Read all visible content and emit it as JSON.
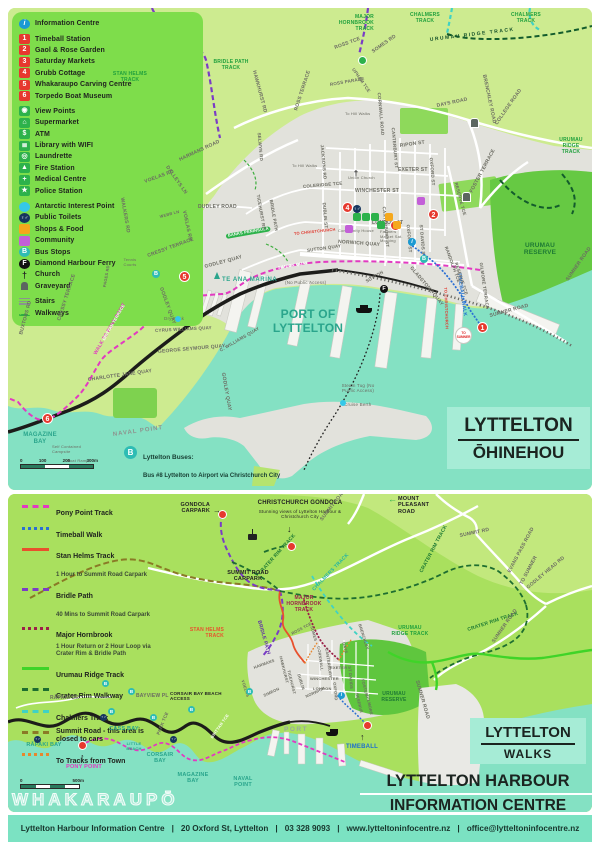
{
  "palette": {
    "land_top": "#cdeb90",
    "land_bottom": "#a9e05e",
    "water": "#84e1c3",
    "urban": "#e2e2dc",
    "legend_green": "#7edd4b",
    "title_box": "#a6ecd6",
    "footer": "#7be2c2",
    "marker_red": "#e6392e",
    "bus_teal": "#2ebcb4",
    "info_blue": "#1b9ad2",
    "shops_orange": "#f5a81c",
    "community_purple": "#c35fd8",
    "antarctic_cyan": "#35c8e8"
  },
  "legend": {
    "info_label": "Information Centre",
    "info_letter": "i",
    "bus_letter": "B",
    "ferry_letter": "F",
    "numbered": [
      {
        "num": "1",
        "label": "Timeball Station"
      },
      {
        "num": "2",
        "label": "Gaol & Rose Garden"
      },
      {
        "num": "3",
        "label": "Saturday Markets"
      },
      {
        "num": "4",
        "label": "Grubb Cottage"
      },
      {
        "num": "5",
        "label": "Whakaraupo Carving Centre"
      },
      {
        "num": "6",
        "label": "Torpedo Boat Museum"
      }
    ],
    "amenities": [
      {
        "glyph": "◉",
        "label": "View Points"
      },
      {
        "glyph": "⌂",
        "label": "Supermarket"
      },
      {
        "glyph": "$",
        "label": "ATM"
      },
      {
        "glyph": "≣",
        "label": "Library with WIFI"
      },
      {
        "glyph": "◎",
        "label": "Laundrette"
      },
      {
        "glyph": "▲",
        "label": "Fire Station"
      },
      {
        "glyph": "+",
        "label": "Medical Centre"
      },
      {
        "glyph": "★",
        "label": "Police Station"
      }
    ],
    "features": [
      {
        "label": "Antarctic Interest Point"
      },
      {
        "label": "Public Toilets"
      },
      {
        "label": "Shops & Food"
      },
      {
        "label": "Community"
      },
      {
        "label": "Bus Stops"
      },
      {
        "label": "Diamond Harbour Ferry"
      },
      {
        "label": "Church"
      },
      {
        "label": "Graveyard"
      }
    ],
    "stairs_label": "Stairs",
    "walkways_label": "Walkways",
    "toilets_glyph": "♀♂",
    "church_glyph": "†"
  },
  "top_map": {
    "title_line1": "LYTTELTON",
    "title_line2": "ŌHINEHOU",
    "markers": [
      "1",
      "2",
      "3",
      "4",
      "5",
      "6"
    ],
    "tracks": {
      "stan_helms": "STAN HELMS TRACK",
      "bridle_path": "BRIDLE PATH TRACK",
      "major_hornbrook": "MAJOR HORNBROOK TRACK",
      "chalmers1": "CHALMERS TRACK",
      "chalmers2": "CHALMERS TRACK",
      "urumau_ridge": "URUMAU RIDGE TRACK",
      "urumau_stack": "URUMAU RIDGE TRACK",
      "timeball_walk": "TIMEBALL WALK",
      "walk_pony": "WALK TO PONY POINT",
      "to_christchurch_v": "TO CHRISTCHURCH",
      "to_christchurch": "TO CHRISTCHURCH",
      "banks_peninsula": "BANKS PENINSULA"
    },
    "roads": {
      "harmans_road": "HARMANS ROAD",
      "dalleys_ln": "DALLEYS LN",
      "voelas_rd": "VOELAS RD",
      "voelas_rd2": "VOELAS RD",
      "walkers_rd": "WALKERS RD",
      "webb_ln": "WEBB LN",
      "cressy_terrace": "CRESSY TERRACE",
      "cressy_terrace2": "CRESSY TERRACE",
      "buxtons_rd": "BUXTONS RD",
      "pages_rd": "PAGES RD",
      "godley_quay": "GODLEY QUAY",
      "godley_quay2": "GODLEY QUAY",
      "godley_quay3": "GODLEY QUAY",
      "cyrus_williams": "CYRUS WILLIAMS QUAY",
      "c_williams": "C. WILLIAMS QUAY",
      "george_seymour": "GEORGE SEYMOUR QUAY",
      "charlotte_jane": "CHARLOTTE JANE QUAY",
      "brittan_terrace": "BRITTAN TERRACE",
      "simeon_quay": "SIMEON QUAY",
      "sutton_quay": "SUTTON QUAY",
      "sutton": "SUTTON",
      "norwich_quay": "NORWICH QUAY",
      "gladstone_quay": "GLADSTONE QUAY",
      "dudley_road": "DUDLEY ROAD",
      "ticehurst_rd": "TICEHURST RD",
      "bridle_path_rd": "BRIDLE PATH",
      "hawkhurst_rd": "HAWKHURST RD",
      "selwyn_rd": "SELWYN RD",
      "jacksons_rd": "JACKSONS RD",
      "dublin_st": "DUBLIN ST",
      "coleridge_tce": "COLERIDGE TCE",
      "winchester_st": "WINCHESTER ST",
      "london_st": "LONDON ST",
      "canterbury_st": "CANTERBURY ST",
      "canterbury_st2": "CANTERBURY ST",
      "exeter_st": "EXETER ST",
      "oxford_st": "OXFORD ST",
      "oxford_st2": "OXFORD ST",
      "ripon_st": "RIPON ST",
      "st_davids_st": "ST DAVIDS ST",
      "ross_tce": "ROSS TCE",
      "ross_terrace": "ROSS TERRACE",
      "ross_parade": "ROSS PARADE",
      "upham_tce": "UPHAM TCE",
      "somes_rd": "SOMES RD",
      "cornwall_road": "CORNWALL ROAD",
      "days_road": "DAYS ROAD",
      "brenchley_road": "BRENCHLEY ROAD",
      "college_road": "COLLEGE ROAD",
      "foster_terrace": "FOSTER TERRACE",
      "reserve_tce": "RESERVE TCE",
      "reserve_tce2": "RESERVE TCE",
      "randolph_tce": "RANDOLPH TCE",
      "gilmore_terrace": "GILMORE TERRACE",
      "sumner_road": "SUMNER ROAD",
      "sumner_road2": "SUMNER ROAD"
    },
    "places": {
      "port": "PORT OF LYTTELTON",
      "te_ana_marina": "TE ANA MARINA",
      "no_public_access": "(No Public Access)",
      "steam_tug": "Steam Tug (No Public Access)",
      "cruise_berth": "Cruise Berth",
      "dry_dock": "Dry Dock",
      "tennis_courts": "Tennis Courts",
      "magazine_bay": "MAGAZINE BAY",
      "naval_point": "NAVAL POINT",
      "self_campsite": "Self Contained Campsite",
      "boat_ramp": "Boat Ramp",
      "to_hill_walks1": "To Hill Walks",
      "to_hill_walks2": "To Hill Walks",
      "union_church": "Union Church",
      "community_house": "Community House",
      "farmers_market": "Farmers Market Sat. Morning",
      "urumau_reserve": "URUMAU RESERVE",
      "to_sumner": "TO SUMNER"
    },
    "bus": {
      "title": "Lyttelton Buses:",
      "line1": "Bus #8 Lyttelton to Airport via Christchurch City",
      "line2": "Bus #155 Shoppers' Bus to Eastgate Mall"
    },
    "scale": {
      "s0": "0",
      "s100": "100",
      "s200": "200",
      "s300": "300m"
    }
  },
  "walks_legend": {
    "items": [
      {
        "name": "Pony Point Track",
        "desc": "",
        "color": "#e23ac1",
        "style": "dashed"
      },
      {
        "name": "Timeball Walk",
        "desc": "",
        "color": "#2a6fd4",
        "style": "dotted"
      },
      {
        "name": "Stan Helms Track",
        "desc": "1 Hour to Summit Road Carpark",
        "color": "#e8512d",
        "style": "solid"
      },
      {
        "name": "Bridle Path",
        "desc": "40 Mins to Summit Road Carpark",
        "color": "#7a3cc6",
        "style": "dashed"
      },
      {
        "name": "Major Hornbrook",
        "desc": "1 Hour Return or 2 Hour Loop via Crater Rim & Bridle Path",
        "color": "#9c2048",
        "style": "dotted"
      },
      {
        "name": "Urumau Ridge Track",
        "desc": "",
        "color": "#3fd428",
        "style": "solid"
      },
      {
        "name": "Crater Rim Walkway",
        "desc": "",
        "color": "#1e6e30",
        "style": "dashed"
      },
      {
        "name": "Chalmers Track",
        "desc": "",
        "color": "#3fd2c4",
        "style": "dashed"
      },
      {
        "name": "Summit Road - this area is closed to cars",
        "desc": "",
        "color": "#8a7a26",
        "style": "dashed"
      },
      {
        "name": "To Tracks from Town",
        "desc": "",
        "color": "#e8862d",
        "style": "dotted"
      }
    ]
  },
  "bottom_map": {
    "box_line1": "LYTTELTON",
    "box_line2": "WALKS",
    "big_line1": "LYTTELTON HARBOUR",
    "big_line2": "INFORMATION CENTRE",
    "whakaraupo": "WHAKARAUPŌ",
    "labels": {
      "gondola_carpark": "GONDOLA CARPARK",
      "christchurch_gondola": "CHRISTCHURCH GONDOLA",
      "gondola_desc": "Stunning views of Lyttelton Harbour & Christchurch City",
      "mount_pleasant": "MOUNT PLEASANT ROAD",
      "summit_road": "SUMMIT ROAD",
      "summit_rd": "SUMMIT RD",
      "crater_rim1": "CRATER RIM TRACK",
      "crater_rim2": "CRATER RIM TRACK",
      "crater_rim3": "CRATER RIM TRACK",
      "chalmers": "CHALMERS TRACK",
      "major_hornbrook": "MAJOR HORNBROOK TRACK",
      "stan_helms": "STAN HELMS TRACK",
      "summit_carpark": "SUMMIT ROAD CARPARK",
      "bridle_path": "BRIDLE PATH",
      "evans_pass": "EVANS PASS ROAD",
      "to_sumner": "TO SUMNER",
      "godley_head": "GODLEY HEAD RD",
      "sumner_road": "SUMNER ROAD",
      "sumner_road2": "SUMNER ROAD",
      "urumau_ridge": "URUMAU RIDGE TRACK",
      "urumau_reserve": "URUMAU RESERVE",
      "timeball": "TIMEBALL",
      "port": "PORT",
      "rapaki_dr": "RĀPAKI DR",
      "rapaki_bay": "RĀPAKI BAY",
      "pony_point": "PONY POINT",
      "cass_bay": "CASS BAY",
      "little_beach": "LITTLE BEACH",
      "bayview_pl": "BAYVIEW PL",
      "corsair_access": "CORSAIR BAY BEACH ACCESS",
      "park_tce": "PARK TCE",
      "corsair_bay": "CORSAIR BAY",
      "magazine_bay": "MAGAZINE BAY",
      "naval_point": "NAVAL POINT",
      "brittan_tce": "BRITTAN TCE",
      "voelas": "VOELAS"
    },
    "streets": {
      "harmans": "HARMANS",
      "ross_tce": "ROSS TCE",
      "somes": "SOMES",
      "cornwall": "CORNWALL",
      "canterbury": "CANTERBURY",
      "days": "DAYS",
      "brenchley": "BRENCHLEY",
      "hawkhurst": "HAWKHURST",
      "ticehurst": "TICEHURST",
      "dublin": "DUBLIN",
      "winchester": "WINCHESTER",
      "london": "LONDON",
      "norwich": "NORWICH",
      "oxford": "OXFORD",
      "st_davids": "ST DAVIDS",
      "exeter": "EXETER",
      "foster": "FOSTER",
      "gilmore": "GILMORE",
      "reserve": "RESERVE",
      "simeon": "SIMEON"
    },
    "scale": {
      "s0": "0",
      "s500": "500m"
    },
    "icons": {
      "left_arrow": "←",
      "right_arrow": "→",
      "up_arrow": "↑",
      "down_arrow": "↓"
    }
  },
  "footer": {
    "name": "Lyttelton Harbour Information Centre",
    "sep": "|",
    "address": "20 Oxford St, Lyttelton",
    "phone": "03 328 9093",
    "website": "www.lytteltoninfocentre.nz",
    "email": "office@lytteltoninfocentre.nz"
  }
}
